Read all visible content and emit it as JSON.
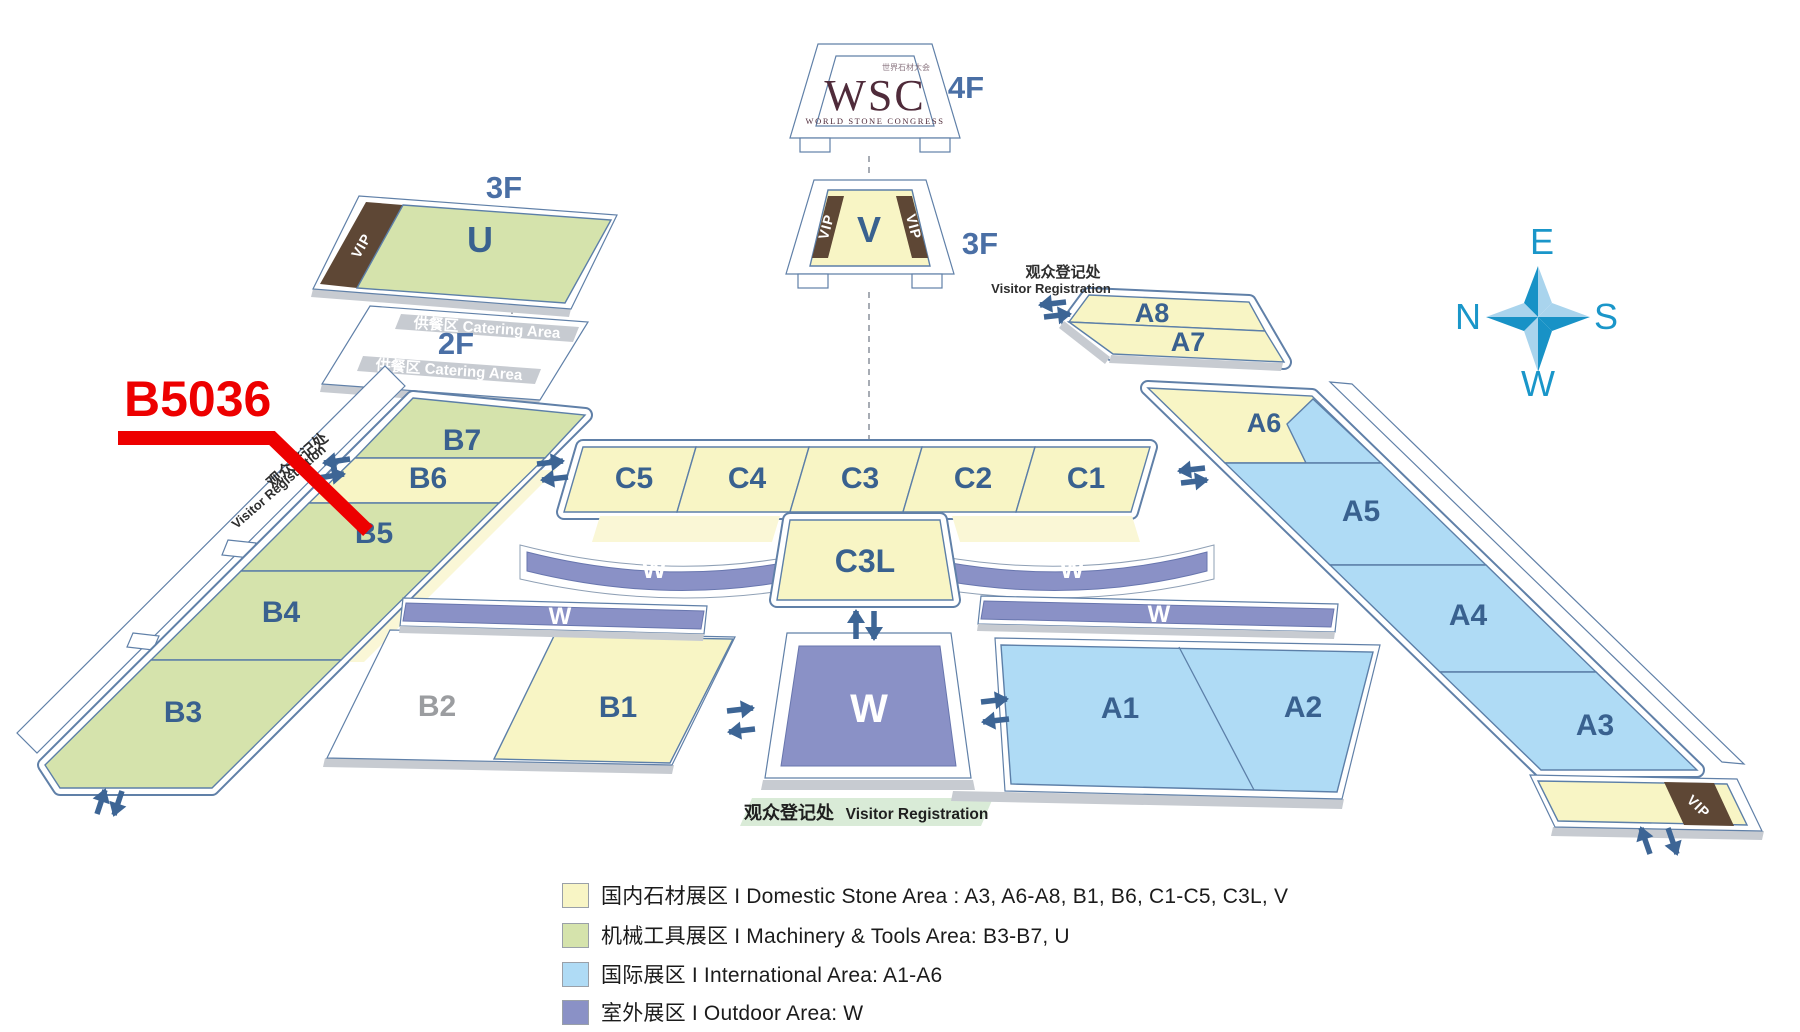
{
  "annotation": {
    "booth": "B5036"
  },
  "logo": {
    "abbr": "WSC",
    "name": "WORLD STONE CONGRESS",
    "zh": "世界石材大会"
  },
  "floors": {
    "f4": "4F",
    "f3": "3F",
    "f2": "2F"
  },
  "vip_label": "VIP",
  "catering_label": "供餐区  Catering Area",
  "registration": {
    "zh": "观众登记处",
    "en": "Visitor Registration"
  },
  "halls": {
    "u": "U",
    "v": "V",
    "w": "W",
    "b1": "B1",
    "b2": "B2",
    "b3": "B3",
    "b4": "B4",
    "b5": "B5",
    "b6": "B6",
    "b7": "B7",
    "c1": "C1",
    "c2": "C2",
    "c3": "C3",
    "c4": "C4",
    "c5": "C5",
    "c3l": "C3L",
    "a1": "A1",
    "a2": "A2",
    "a3": "A3",
    "a4": "A4",
    "a5": "A5",
    "a6": "A6",
    "a7": "A7",
    "a8": "A8"
  },
  "compass": {
    "top": "E",
    "left": "N",
    "right": "S",
    "bottom": "W"
  },
  "legend": [
    {
      "color": "#F8F5C5",
      "label": "国内石材展区 I Domestic Stone Area : A3, A6-A8, B1, B6, C1-C5, C3L, V"
    },
    {
      "color": "#D5E3AC",
      "label": "机械工具展区 I Machinery & Tools Area: B3-B7, U"
    },
    {
      "color": "#AFDBF5",
      "label": "国际展区 I International Area:  A1-A6"
    },
    {
      "color": "#8A91C6",
      "label": "室外展区 I Outdoor Area:  W"
    }
  ],
  "colors": {
    "domestic_yellow": "#F8F5C5",
    "machinery_green": "#D5E3AC",
    "international_blue": "#AFDBF5",
    "outdoor_purple": "#8A91C6",
    "vip_brown": "#5E4735",
    "annotation_red": "#ED0000",
    "compass_blue": "#1A96C9",
    "label_blue": "#39618F"
  }
}
